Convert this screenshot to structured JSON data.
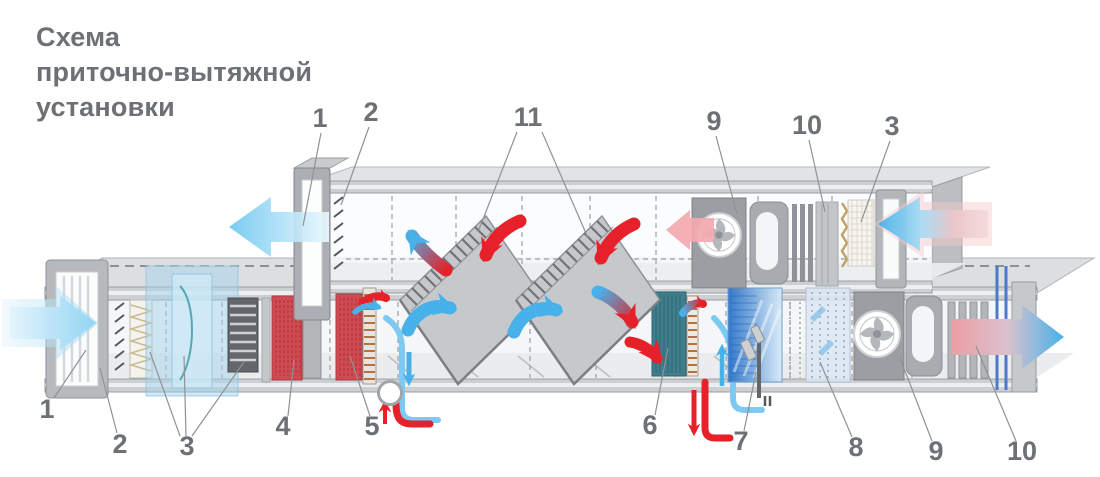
{
  "title": "Схема\nприточно-вытяжной\nустановки",
  "diagram": {
    "callouts_top": [
      {
        "text": "1"
      },
      {
        "text": "2"
      },
      {
        "text": "11"
      },
      {
        "text": "9"
      },
      {
        "text": "10"
      },
      {
        "text": "3"
      }
    ],
    "callouts_bottom": [
      {
        "text": "1"
      },
      {
        "text": "2"
      },
      {
        "text": "3"
      },
      {
        "text": "4"
      },
      {
        "text": "5"
      },
      {
        "text": "6"
      },
      {
        "text": "7"
      },
      {
        "text": "8"
      },
      {
        "text": "9"
      },
      {
        "text": "10"
      }
    ],
    "colors": {
      "hot_flow": "#e62129",
      "cold_flow": "#47b1ea",
      "supply_intake": "#90d4f3",
      "exhaust_warm": "#f3a9af",
      "heater_coil": "#d04b51",
      "cooler_coil": "#3f7e8c",
      "humidifier": "#2a72c8",
      "duct_frame": "#b3b6b9",
      "label_text": "#6d7174"
    }
  }
}
